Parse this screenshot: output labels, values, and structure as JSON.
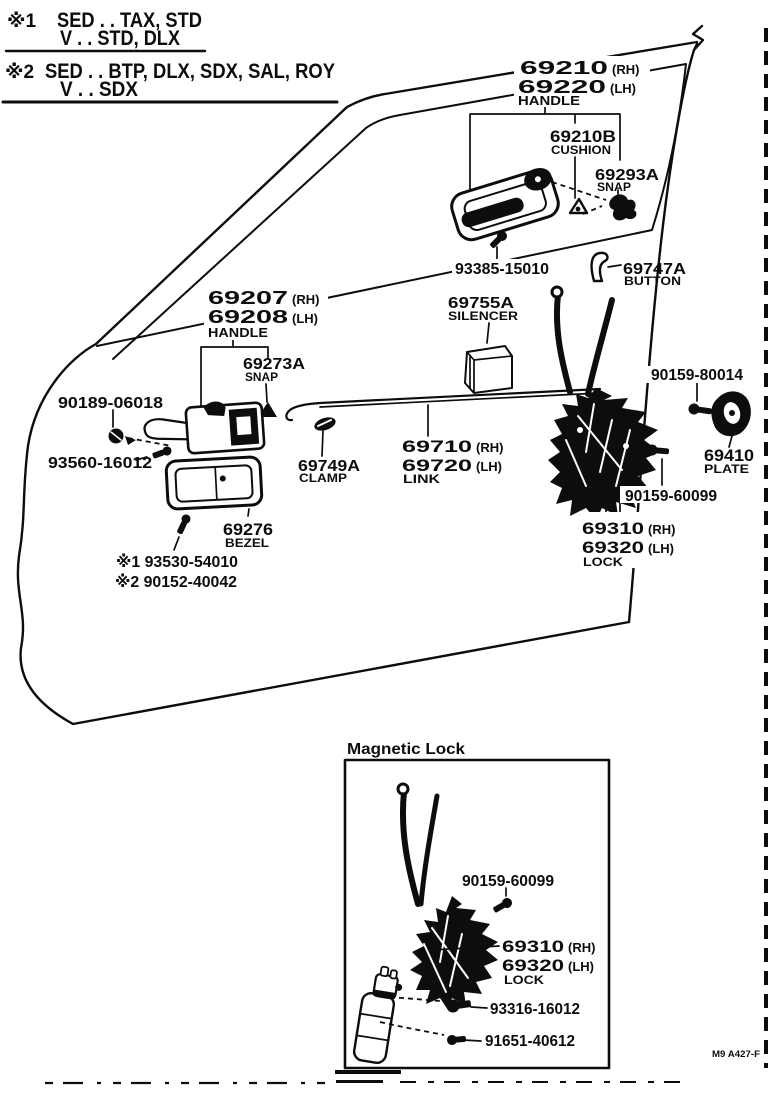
{
  "page": {
    "legend": {
      "note1": {
        "marker": "※1",
        "line1": "SED . . TAX, STD",
        "line2": "V . . STD, DLX"
      },
      "note2": {
        "marker": "※2",
        "line1": "SED . . BTP, DLX, SDX, SAL, ROY",
        "line2": "V . . SDX"
      }
    },
    "diagram": {
      "outside_handle": {
        "num_rh": "69210",
        "rh": "(RH)",
        "num_lh": "69220",
        "lh": "(LH)",
        "name": "HANDLE"
      },
      "cushion": {
        "num": "69210B",
        "name": "CUSHION"
      },
      "snap_outer": {
        "num": "69293A",
        "name": "SNAP"
      },
      "screw_93385": {
        "num": "93385-15010"
      },
      "button": {
        "num": "69747A",
        "name": "BUTTON"
      },
      "inside_handle": {
        "num_rh": "69207",
        "rh": "(RH)",
        "num_lh": "69208",
        "lh": "(LH)",
        "name": "HANDLE"
      },
      "silencer": {
        "num": "69755A",
        "name": "SILENCER"
      },
      "snap_inner": {
        "num": "69273A",
        "name": "SNAP"
      },
      "grommet_90189": {
        "num": "90189-06018"
      },
      "screw_93560": {
        "num": "93560-16012"
      },
      "clamp": {
        "num": "69749A",
        "name": "CLAMP"
      },
      "link": {
        "num_rh": "69710",
        "rh": "(RH)",
        "num_lh": "69720",
        "lh": "(LH)",
        "name": "LINK"
      },
      "screw_90159_80014": {
        "num": "90159-80014"
      },
      "plate": {
        "num": "69410",
        "name": "PLATE"
      },
      "screw_90159_60099": {
        "num": "90159-60099"
      },
      "lock": {
        "num_rh": "69310",
        "rh": "(RH)",
        "num_lh": "69320",
        "lh": "(LH)",
        "name": "LOCK"
      },
      "bezel": {
        "num": "69276",
        "name": "BEZEL"
      },
      "variant_screws": {
        "line1": "※1 93530-54010",
        "line2": "※2 90152-40042"
      }
    },
    "magnetic_lock": {
      "title": "Magnetic Lock",
      "screw_90159_60099": {
        "num": "90159-60099"
      },
      "lock": {
        "num_rh": "69310",
        "rh": "(RH)",
        "num_lh": "69320",
        "lh": "(LH)",
        "name": "LOCK"
      },
      "screw_93316": {
        "num": "93316-16012"
      },
      "screw_91651": {
        "num": "91651-40612"
      }
    },
    "footer": {
      "code": "M9  A427-F"
    }
  }
}
